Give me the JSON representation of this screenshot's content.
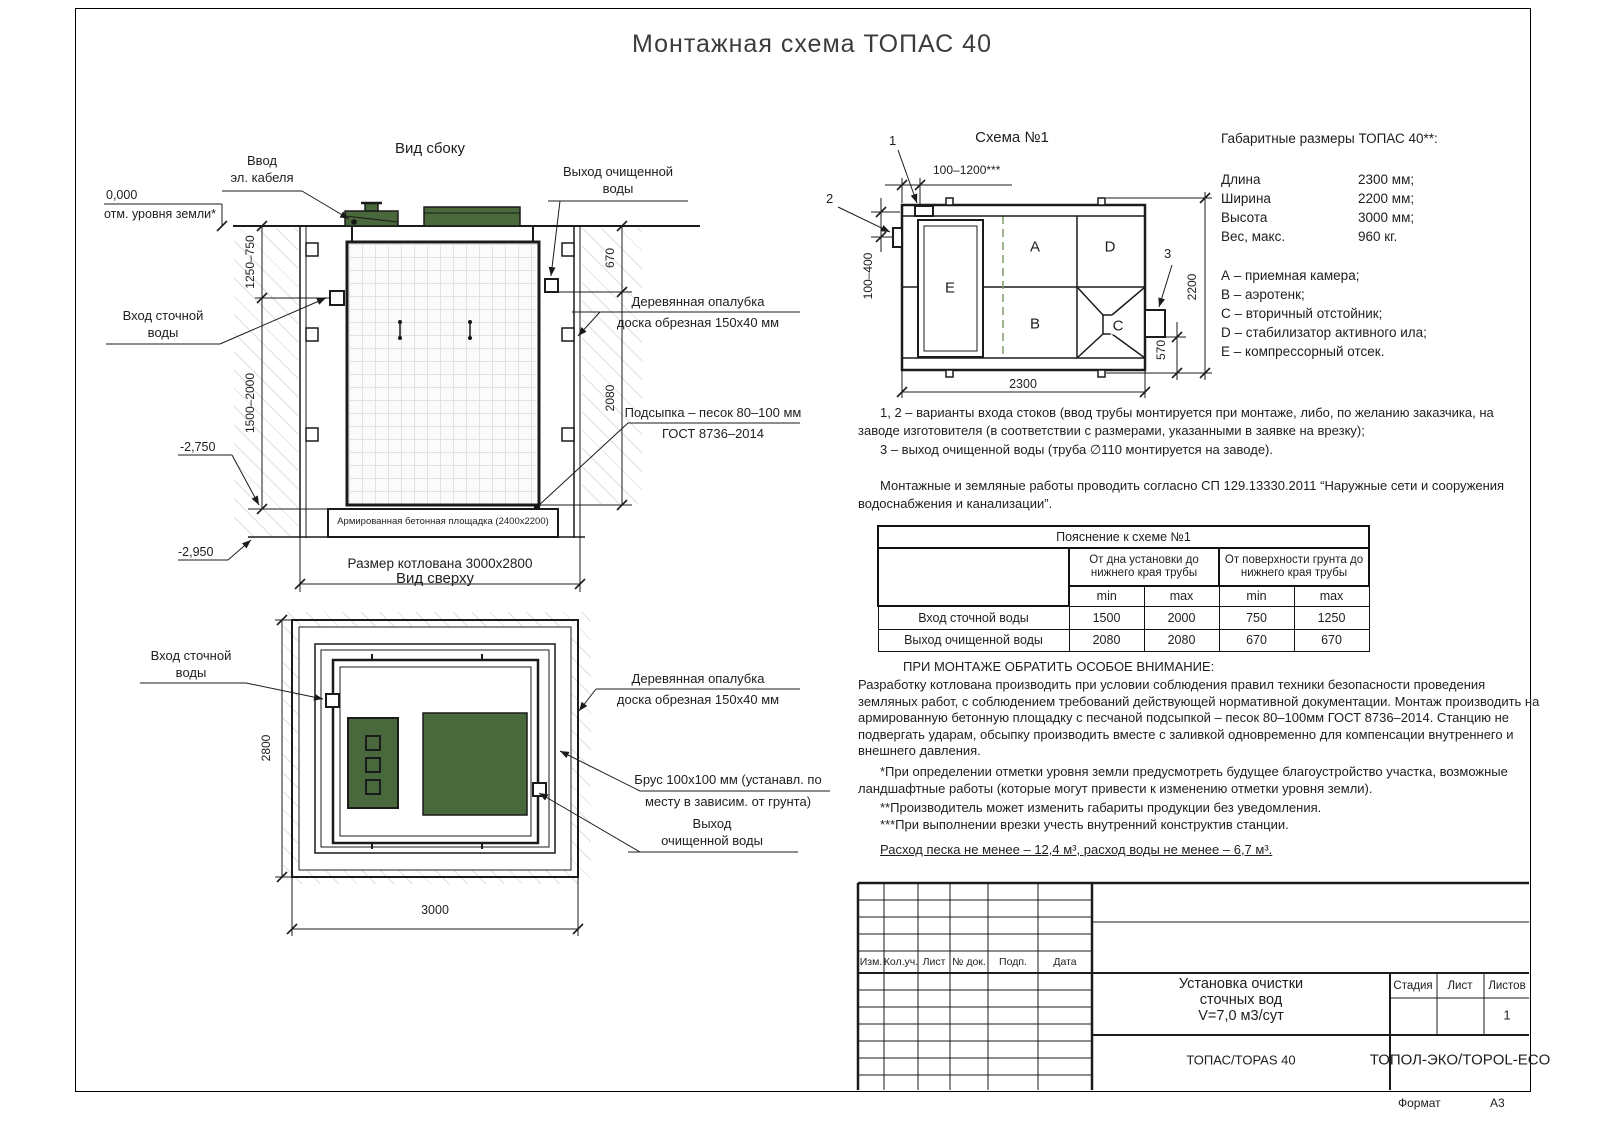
{
  "page": {
    "title": "Монтажная схема ТОПАС 40",
    "format_label": "Формат",
    "format_value": "А3"
  },
  "side_view": {
    "title": "Вид сбоку",
    "elev_zero": "0,000",
    "elev_zero_label": "отм. уровня земли*",
    "cable_label_1": "Ввод",
    "cable_label_2": "эл. кабеля",
    "outlet_label_1": "Выход очищенной",
    "outlet_label_2": "воды",
    "inlet_label_1": "Вход сточной",
    "inlet_label_2": "воды",
    "formwork_label_1": "Деревянная опалубка",
    "formwork_label_2": "доска обрезная 150х40 мм",
    "sand_label_1": "Подсыпка – песок 80–100 мм",
    "sand_label_2": "ГОСТ 8736–2014",
    "pad_label": "Армированная бетонная площадка (2400х2200)",
    "pit_label": "Размер котлована 3000х2800",
    "dim_upper": "1250–750",
    "dim_lower": "1500–2000",
    "dim_out_top": "670",
    "dim_out_bottom": "2080",
    "elev_pad": "-2,750",
    "elev_bottom": "-2,950"
  },
  "top_view": {
    "title": "Вид сверху",
    "inlet_label_1": "Вход сточной",
    "inlet_label_2": "воды",
    "formwork_label_1": "Деревянная опалубка",
    "formwork_label_2": "доска обрезная 150х40 мм",
    "beam_label_1": "Брус 100х100 мм (устанавл. по",
    "beam_label_2": "месту в зависим. от грунта)",
    "outlet_label_1": "Выход",
    "outlet_label_2": "очищенной воды",
    "dim_height": "2800",
    "dim_width": "3000"
  },
  "schema": {
    "title": "Схема №1",
    "chambers": {
      "a": "A",
      "b": "B",
      "c": "C",
      "d": "D",
      "e": "E"
    },
    "marks": {
      "m1": "1",
      "m2": "2",
      "m3": "3"
    },
    "dims": {
      "top": "100–1200***",
      "left": "100–400",
      "right": "2200",
      "outlet": "570",
      "bottom": "2300"
    }
  },
  "specs": {
    "title": "Габаритные размеры ТОПАС 40**:",
    "rows": [
      {
        "label": "Длина",
        "value": "2300 мм;"
      },
      {
        "label": "Ширина",
        "value": "2200 мм;"
      },
      {
        "label": "Высота",
        "value": "3000 мм;"
      },
      {
        "label": "Вес, макс.",
        "value": "960 кг."
      }
    ],
    "legend": [
      "А – приемная камера;",
      "В – аэротенк;",
      "С – вторичный отстойник;",
      "D – стабилизатор активного ила;",
      "Е – компрессорный отсек."
    ]
  },
  "notes": {
    "variants": "1, 2 – варианты входа  стоков (ввод трубы монтируется при монтаже, либо, по желанию заказчика, на заводе изготовителя (в соответствии с размерами, указанными в заявке на врезку);",
    "outlet": "3 – выход очищенной воды (труба ∅110 монтируется на заводе).",
    "mounting": "Монтажные и земляные работы проводить согласно СП 129.13330.2011 “Наружные сети и сооружения водоснабжения и канализации”."
  },
  "table": {
    "title": "Пояснение к схеме №1",
    "group1": "От дна установки до нижнего края трубы",
    "group2": "От поверхности грунта до нижнего края трубы",
    "min": "min",
    "max": "max",
    "rows": [
      {
        "name": "Вход сточной воды",
        "c1": "1500",
        "c2": "2000",
        "c3": "750",
        "c4": "1250"
      },
      {
        "name": "Выход очищенной воды",
        "c1": "2080",
        "c2": "2080",
        "c3": "670",
        "c4": "670"
      }
    ]
  },
  "attention": {
    "title": "ПРИ МОНТАЖЕ ОБРАТИТЬ ОСОБОЕ ВНИМАНИЕ:",
    "body": "Разработку котлована производить при условии соблюдения правил техники безопасности проведения земляных работ, с соблюдением требований действующей нормативной документации.  Монтаж производить на армированную бетонную площадку с песчаной подсыпкой – песок 80–100мм ГОСТ 8736–2014. Станцию не подвергать ударам, обсыпку производить вместе с заливкой одновременно для компенсации внутреннего и внешнего давления.",
    "fn1": "*При определении отметки уровня земли предусмотреть будущее благоустройство участка, возможные ландшафтные работы (которые могут привести к изменению отметки уровня земли).",
    "fn2": "**Производитель может изменить габариты продукции без уведомления.",
    "fn3": "***При выполнении врезки учесть внутренний конструктив станции.",
    "consumption": "Расход песка не менее – 12,4 м³, расход воды не менее – 6,7 м³."
  },
  "title_block": {
    "cols": [
      "Изм.",
      "Кол.уч.",
      "Лист",
      "№ док.",
      "Подп.",
      "Дата"
    ],
    "doc_line1": "Установка очистки",
    "doc_line2": "сточных вод",
    "doc_line3": "V=7,0 м3/сут",
    "stage": "Стадия",
    "sheet": "Лист",
    "sheets": "Листов",
    "sheets_value": "1",
    "model": "ТОПАС/TOPAS 40",
    "company": "ТОПОЛ-ЭКО/TOPOL-ECO"
  }
}
